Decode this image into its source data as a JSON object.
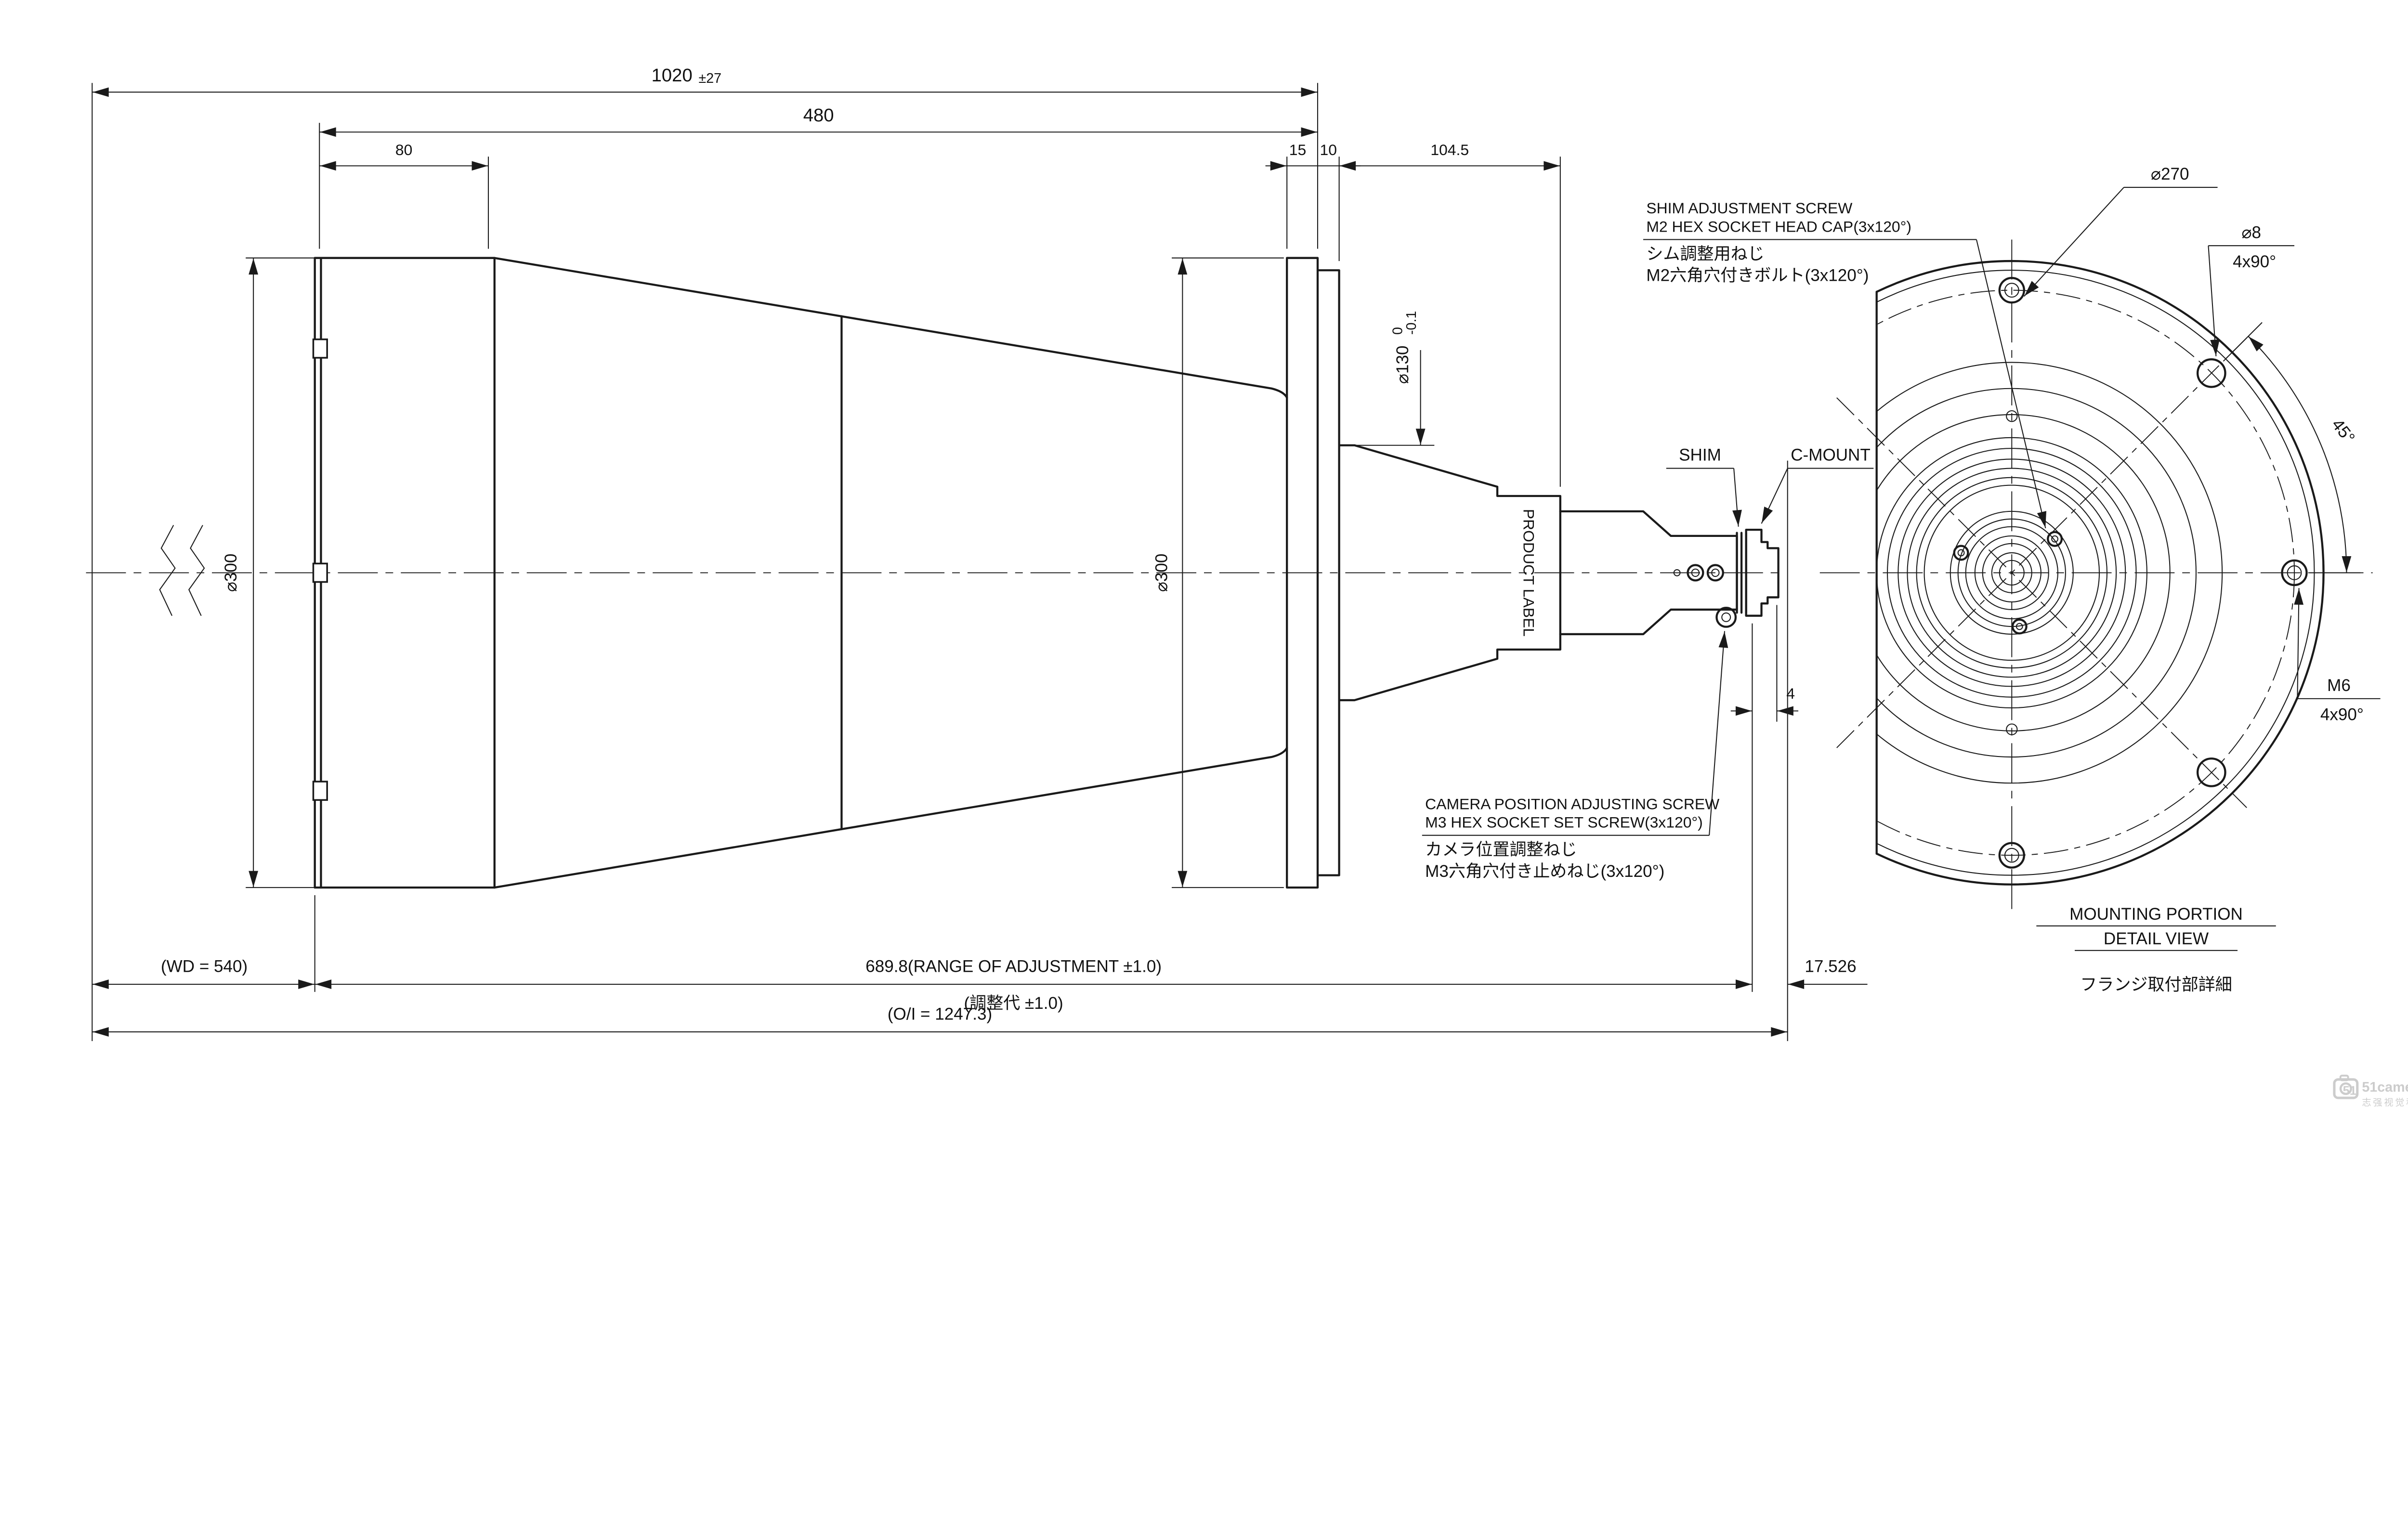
{
  "side_view": {
    "dims": {
      "overall_top": "1020",
      "overall_top_tol": "±27",
      "d480": "480",
      "d80": "80",
      "d15": "15",
      "d10": "10",
      "d104_5": "104.5",
      "dia300_front": "⌀300",
      "dia300_flange": "⌀300",
      "dia130": "⌀130",
      "dia130_tol_hi": "0",
      "dia130_tol_lo": "-0.1",
      "d4": "4",
      "wd": "(WD = 540)",
      "range": "689.8(RANGE OF ADJUSTMENT ±1.0)",
      "range_jp": "(調整代 ±1.0)",
      "ffd": "17.526",
      "oi": "(O/I = 1247.3)"
    },
    "labels": {
      "shim": "SHIM",
      "cmount": "C-MOUNT",
      "product_label": "PRODUCT LABEL"
    },
    "annotations": {
      "shim_screw": {
        "l1": "SHIM ADJUSTMENT SCREW",
        "l2": "M2 HEX SOCKET HEAD CAP(3x120°)",
        "l3": "シム調整用ねじ",
        "l4": "M2六角穴付きボルト(3x120°)"
      },
      "camera_screw": {
        "l1": "CAMERA POSITION ADJUSTING SCREW",
        "l2": "M3 HEX SOCKET SET SCREW(3x120°)",
        "l3": "カメラ位置調整ねじ",
        "l4": "M3六角穴付き止めねじ(3x120°)"
      }
    }
  },
  "detail_view": {
    "dia270": "⌀270",
    "dia8": "⌀8",
    "dia8_qty": "4x90°",
    "angle45": "45°",
    "m6": "M6",
    "m6_qty": "4x90°",
    "title_line1": "MOUNTING PORTION",
    "title_line2": "DETAIL VIEW",
    "title_jp": "フランジ取付部詳細"
  },
  "watermark": {
    "brand": "51camera",
    "brand_jp": "志强视觉科技",
    "icon": "51"
  },
  "colors": {
    "line": "#1a1a1a",
    "watermark": "#cccccc",
    "background": "#ffffff"
  }
}
